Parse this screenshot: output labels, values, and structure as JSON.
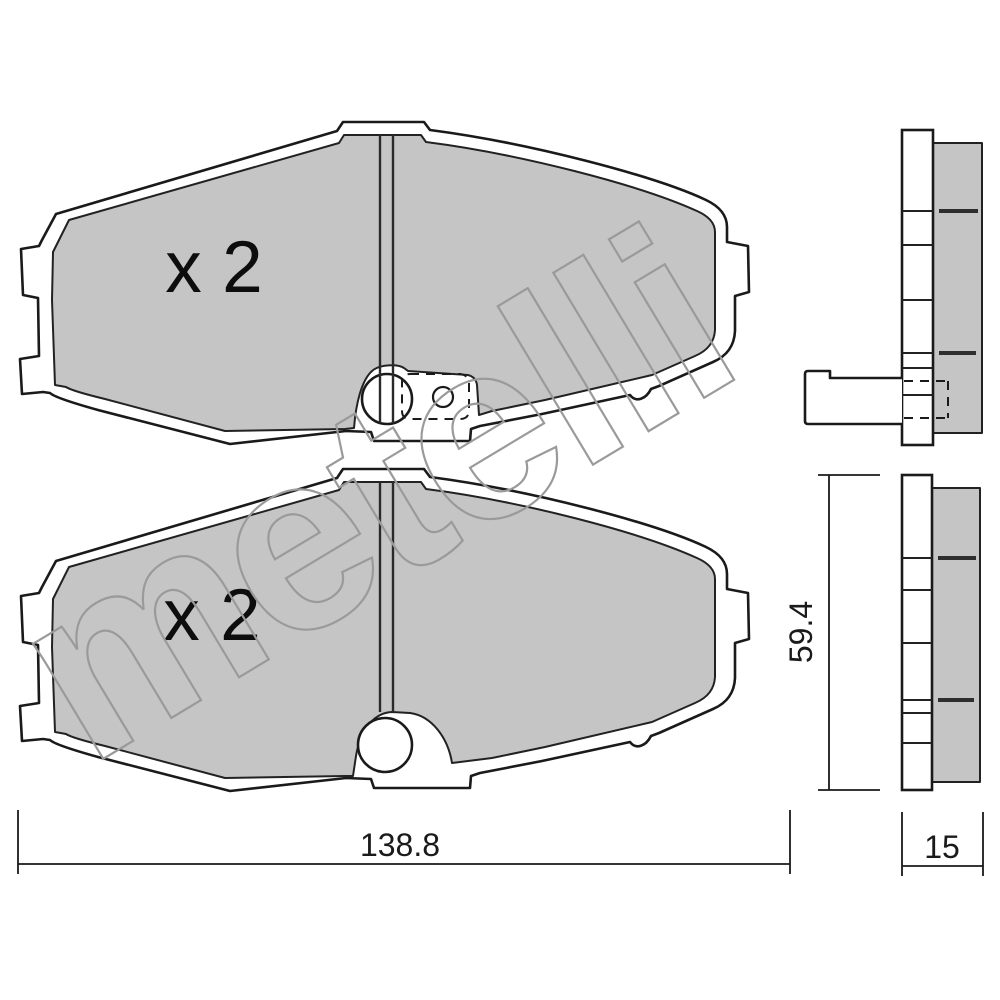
{
  "drawing": {
    "title": "brake-pad-technical-drawing",
    "watermark": "metelli",
    "quantity_top": "x 2",
    "quantity_bottom": "x 2",
    "dimensions": {
      "width": "138.8",
      "height": "59.4",
      "thickness": "15"
    },
    "colors": {
      "friction_material": "#c5c5c5",
      "outline": "#1a1a1a",
      "watermark": "#9a9a9a",
      "background": "#ffffff"
    }
  }
}
